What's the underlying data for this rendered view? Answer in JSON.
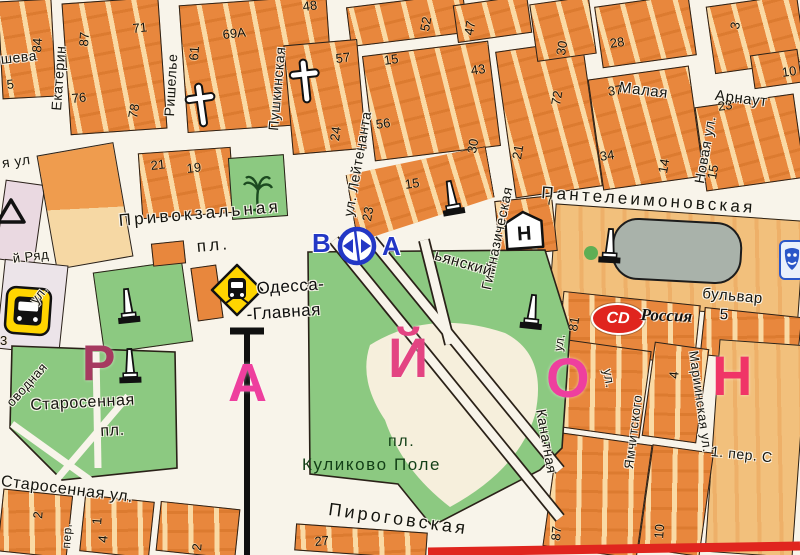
{
  "title": "Одесса — карта привокзального района",
  "colors": {
    "street": "#f8f4ea",
    "orange": "#e8873d",
    "tan": "#f2c07c",
    "park": "#8cc981",
    "parktext": "#123f16",
    "pink": "#e83e92",
    "blue": "#2337c5",
    "yellow": "#ffd500",
    "red": "#e0251e",
    "gray": "#a9b2aa",
    "pinkblock": "#ead9e1",
    "lavblock": "#ece4e9",
    "railway": "#101010"
  },
  "icons": {
    "hospital_letter": "Н",
    "cd_label": "CD",
    "names": [
      "train-station-icon",
      "bus-station-icon",
      "road-sign-icon",
      "hospital-icon",
      "cd-rossiya-badge",
      "church-cross-icon",
      "monument-icon",
      "palm-tree-icon",
      "theater-icon",
      "warning-triangle-icon",
      "railway-line",
      "gray-building"
    ]
  },
  "district_letters": [
    "Р",
    "А",
    "Й",
    "О",
    "Н"
  ],
  "labels": [
    {
      "t": "шева",
      "x": 0,
      "y": 52,
      "r": -6,
      "s": 14,
      "cls": "st"
    },
    {
      "t": "я ул",
      "x": 1,
      "y": 156,
      "r": -8,
      "s": 14,
      "cls": "st"
    },
    {
      "t": "Екатерин",
      "x": 49,
      "y": 110,
      "r": -86,
      "s": 14,
      "cls": "st"
    },
    {
      "t": "Ришелье",
      "x": 162,
      "y": 116,
      "r": -87,
      "s": 14,
      "cls": "st"
    },
    {
      "t": "Пушкинская",
      "x": 266,
      "y": 130,
      "r": -85,
      "s": 14,
      "cls": "st"
    },
    {
      "t": "ул. Лейтенанта",
      "x": 341,
      "y": 215,
      "r": -80,
      "s": 14,
      "cls": "st"
    },
    {
      "t": "Гимназическая",
      "x": 479,
      "y": 288,
      "r": -78,
      "s": 14,
      "cls": "st"
    },
    {
      "t": "Новая ул.",
      "x": 692,
      "y": 182,
      "r": -80,
      "s": 14,
      "cls": "st"
    },
    {
      "t": "Малая",
      "x": 620,
      "y": 80,
      "r": 7,
      "s": 15,
      "cls": "st"
    },
    {
      "t": "Арнаут",
      "x": 716,
      "y": 88,
      "r": 7,
      "s": 15,
      "cls": "st"
    },
    {
      "t": "Пантелеимоновская",
      "x": 542,
      "y": 184,
      "r": 4,
      "s": 17,
      "cls": "stw"
    },
    {
      "t": "ьянский",
      "x": 437,
      "y": 248,
      "r": 16,
      "s": 15,
      "cls": "st"
    },
    {
      "t": "бульвар",
      "x": 703,
      "y": 286,
      "r": 5,
      "s": 15,
      "cls": "st"
    },
    {
      "t": "Канатная",
      "x": 548,
      "y": 408,
      "r": 80,
      "s": 14,
      "cls": "st"
    },
    {
      "t": "ул.",
      "x": 614,
      "y": 368,
      "r": 80,
      "s": 13,
      "cls": "st"
    },
    {
      "t": "ул.",
      "x": 552,
      "y": 350,
      "r": -80,
      "s": 12,
      "cls": "st"
    },
    {
      "t": "Ямчитского",
      "x": 622,
      "y": 468,
      "r": -83,
      "s": 13,
      "cls": "st"
    },
    {
      "t": "Мариинская ул.",
      "x": 700,
      "y": 350,
      "r": 82,
      "s": 13,
      "cls": "st"
    },
    {
      "t": "1. пер. С",
      "x": 712,
      "y": 444,
      "r": 6,
      "s": 14,
      "cls": "st"
    },
    {
      "t": "Привокзальная",
      "x": 118,
      "y": 212,
      "r": -5,
      "s": 17,
      "cls": "stw"
    },
    {
      "t": "пл.",
      "x": 196,
      "y": 238,
      "r": -5,
      "s": 17,
      "cls": "stw"
    },
    {
      "t": "Старосенная",
      "x": 30,
      "y": 398,
      "r": -3,
      "s": 16,
      "cls": "st"
    },
    {
      "t": "пл.",
      "x": 100,
      "y": 424,
      "r": -3,
      "s": 16,
      "cls": "st"
    },
    {
      "t": "Старосенная ул.",
      "x": 2,
      "y": 474,
      "r": 7,
      "s": 16,
      "cls": "st"
    },
    {
      "t": "Пироговская",
      "x": 330,
      "y": 500,
      "r": 8,
      "s": 18,
      "cls": "stw"
    },
    {
      "t": "й Ряд",
      "x": 12,
      "y": 252,
      "r": -7,
      "s": 13,
      "cls": "st"
    },
    {
      "t": "оводная",
      "x": 4,
      "y": 400,
      "r": -48,
      "s": 13,
      "cls": "st"
    },
    {
      "t": "ул.",
      "x": 28,
      "y": 298,
      "r": -52,
      "s": 13,
      "cls": "st"
    },
    {
      "t": "пер.",
      "x": 60,
      "y": 548,
      "r": -86,
      "s": 12,
      "cls": "st"
    },
    {
      "t": "Одесса-",
      "x": 256,
      "y": 280,
      "r": -4,
      "s": 17,
      "cls": "pl"
    },
    {
      "t": "-Главная",
      "x": 246,
      "y": 306,
      "r": -4,
      "s": 17,
      "cls": "pl"
    },
    {
      "t": "пл.",
      "x": 388,
      "y": 434,
      "r": 0,
      "s": 16,
      "cls": "pk"
    },
    {
      "t": "Куликово Поле",
      "x": 302,
      "y": 456,
      "r": 0,
      "s": 17,
      "cls": "pk"
    },
    {
      "t": "Россия",
      "x": 641,
      "y": 306,
      "r": 2,
      "s": 17,
      "cls": "ros"
    },
    {
      "t": "5",
      "x": 720,
      "y": 307,
      "r": 2,
      "s": 15,
      "cls": "pl"
    },
    {
      "t": "В",
      "x": 312,
      "y": 230,
      "r": 0,
      "s": 26,
      "cls": "bl"
    },
    {
      "t": "А",
      "x": 382,
      "y": 233,
      "r": 0,
      "s": 26,
      "cls": "bl"
    },
    {
      "t": "Р",
      "x": 82,
      "y": 338,
      "r": 0,
      "s": 50,
      "cls": "dl",
      "c": "#a63a60"
    },
    {
      "t": "А",
      "x": 228,
      "y": 356,
      "r": 0,
      "s": 54,
      "cls": "dl",
      "c": "#ee3f9e"
    },
    {
      "t": "Й",
      "x": 388,
      "y": 330,
      "r": 0,
      "s": 56,
      "cls": "dl",
      "c": "#e34482"
    },
    {
      "t": "О",
      "x": 546,
      "y": 350,
      "r": 0,
      "s": 56,
      "cls": "dl",
      "c": "#ee3f9e"
    },
    {
      "t": "Н",
      "x": 712,
      "y": 348,
      "r": 0,
      "s": 56,
      "cls": "dl",
      "c": "#f03567"
    },
    {
      "t": "84",
      "x": 30,
      "y": 52,
      "r": -86,
      "cls": "num"
    },
    {
      "t": "5",
      "x": 6,
      "y": 78,
      "r": -6,
      "cls": "num"
    },
    {
      "t": "87",
      "x": 77,
      "y": 46,
      "r": -86,
      "cls": "num"
    },
    {
      "t": "71",
      "x": 132,
      "y": 22,
      "r": -6,
      "cls": "num"
    },
    {
      "t": "76",
      "x": 71,
      "y": 92,
      "r": -6,
      "cls": "num"
    },
    {
      "t": "78",
      "x": 126,
      "y": 117,
      "r": -80,
      "cls": "num"
    },
    {
      "t": "61",
      "x": 187,
      "y": 60,
      "r": -86,
      "cls": "num"
    },
    {
      "t": "69А",
      "x": 222,
      "y": 28,
      "r": -6,
      "cls": "num"
    },
    {
      "t": "48",
      "x": 302,
      "y": 0,
      "r": -6,
      "cls": "num"
    },
    {
      "t": "52",
      "x": 418,
      "y": 30,
      "r": -80,
      "cls": "num"
    },
    {
      "t": "47",
      "x": 462,
      "y": 34,
      "r": -80,
      "cls": "num"
    },
    {
      "t": "57",
      "x": 335,
      "y": 52,
      "r": -6,
      "cls": "num"
    },
    {
      "t": "24",
      "x": 328,
      "y": 140,
      "r": -82,
      "cls": "num"
    },
    {
      "t": "15",
      "x": 383,
      "y": 54,
      "r": -8,
      "cls": "num"
    },
    {
      "t": "43",
      "x": 470,
      "y": 64,
      "r": -8,
      "cls": "num"
    },
    {
      "t": "56",
      "x": 375,
      "y": 118,
      "r": -8,
      "cls": "num"
    },
    {
      "t": "30",
      "x": 465,
      "y": 152,
      "r": -80,
      "cls": "num"
    },
    {
      "t": "23",
      "x": 360,
      "y": 220,
      "r": -80,
      "cls": "num"
    },
    {
      "t": "15",
      "x": 404,
      "y": 178,
      "r": -8,
      "cls": "num"
    },
    {
      "t": "21",
      "x": 510,
      "y": 158,
      "r": -80,
      "cls": "num"
    },
    {
      "t": "30",
      "x": 554,
      "y": 54,
      "r": -80,
      "cls": "num"
    },
    {
      "t": "28",
      "x": 609,
      "y": 37,
      "r": -8,
      "cls": "num"
    },
    {
      "t": "3",
      "x": 728,
      "y": 28,
      "r": -80,
      "cls": "num"
    },
    {
      "t": "72",
      "x": 549,
      "y": 104,
      "r": -80,
      "cls": "num"
    },
    {
      "t": "37",
      "x": 607,
      "y": 85,
      "r": -8,
      "cls": "num"
    },
    {
      "t": "23",
      "x": 717,
      "y": 100,
      "r": -8,
      "cls": "num"
    },
    {
      "t": "34",
      "x": 599,
      "y": 150,
      "r": -8,
      "cls": "num"
    },
    {
      "t": "14",
      "x": 656,
      "y": 172,
      "r": -80,
      "cls": "num"
    },
    {
      "t": "15",
      "x": 705,
      "y": 178,
      "r": -80,
      "cls": "num"
    },
    {
      "t": "10",
      "x": 781,
      "y": 66,
      "r": -8,
      "cls": "num"
    },
    {
      "t": "7",
      "x": 545,
      "y": 194,
      "r": -6,
      "cls": "num"
    },
    {
      "t": "81",
      "x": 566,
      "y": 330,
      "r": -80,
      "cls": "num"
    },
    {
      "t": "87",
      "x": 549,
      "y": 540,
      "r": -85,
      "cls": "num"
    },
    {
      "t": "10",
      "x": 652,
      "y": 538,
      "r": -85,
      "cls": "num"
    },
    {
      "t": "4",
      "x": 667,
      "y": 378,
      "r": -85,
      "cls": "num"
    },
    {
      "t": "21",
      "x": 150,
      "y": 159,
      "r": -6,
      "cls": "num"
    },
    {
      "t": "19",
      "x": 186,
      "y": 162,
      "r": -6,
      "cls": "num"
    },
    {
      "t": "2",
      "x": 31,
      "y": 518,
      "r": -85,
      "cls": "num"
    },
    {
      "t": "1",
      "x": 90,
      "y": 524,
      "r": -85,
      "cls": "num"
    },
    {
      "t": "4",
      "x": 96,
      "y": 542,
      "r": -85,
      "cls": "num"
    },
    {
      "t": "2",
      "x": 190,
      "y": 550,
      "r": -85,
      "cls": "num"
    },
    {
      "t": "27",
      "x": 314,
      "y": 535,
      "r": -5,
      "cls": "num"
    },
    {
      "t": "3",
      "x": 0,
      "y": 334,
      "r": 0,
      "cls": "num"
    }
  ]
}
